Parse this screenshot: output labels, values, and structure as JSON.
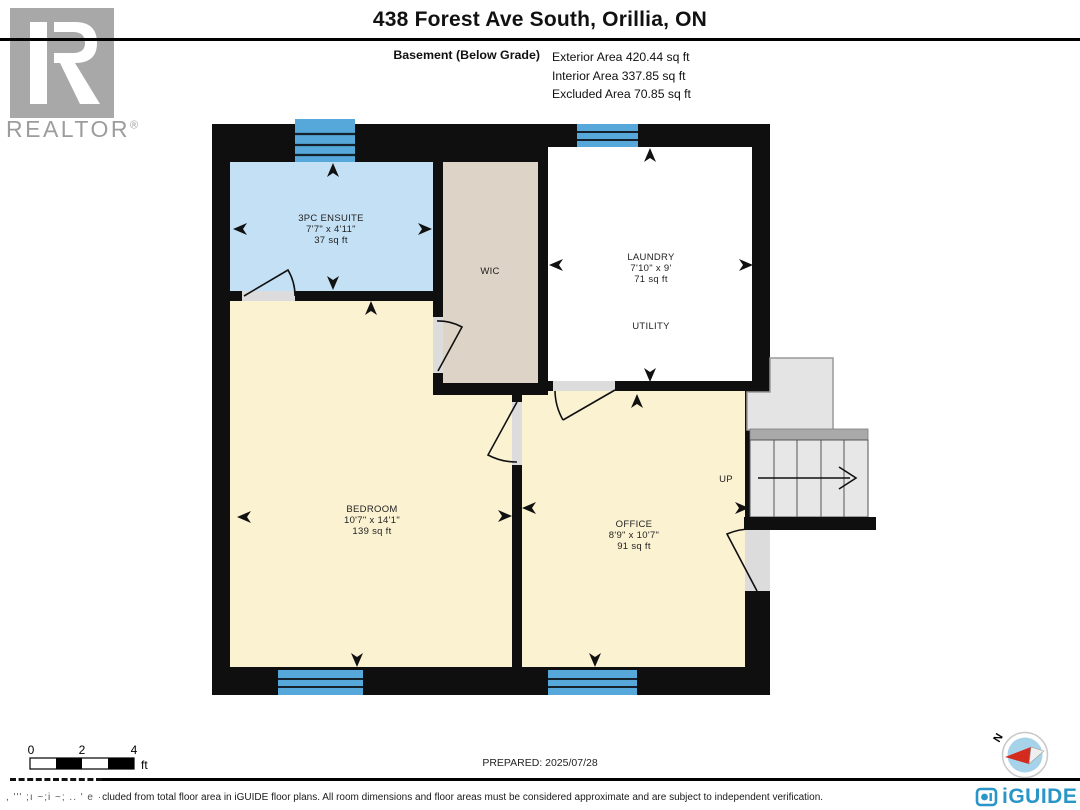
{
  "header": {
    "title": "438 Forest Ave South, Orillia, ON",
    "floor_label": "Basement (Below Grade)",
    "areas": [
      "Exterior Area 420.44 sq ft",
      "Interior Area 337.85 sq ft",
      "Excluded Area 70.85 sq ft"
    ]
  },
  "realtor_logo": {
    "label": "REALTOR",
    "reg": "®"
  },
  "rooms": [
    {
      "name": "3PC ENSUITE",
      "dims": "7'7\" x 4'11\"",
      "area": "37 sq ft"
    },
    {
      "name": "WIC"
    },
    {
      "name": "LAUNDRY",
      "dims": "7'10\" x 9'",
      "area": "71 sq ft"
    },
    {
      "name": "UTILITY"
    },
    {
      "name": "BEDROOM",
      "dims": "10'7\" x 14'1\"",
      "area": "139 sq ft"
    },
    {
      "name": "OFFICE",
      "dims": "8'9\" x 10'7\"",
      "area": "91 sq ft"
    }
  ],
  "stairs": {
    "label": "UP"
  },
  "compass": {
    "north_label": "N"
  },
  "scale_bar": {
    "ticks": [
      "0",
      "2",
      "4"
    ],
    "unit": "ft"
  },
  "footer": {
    "prepared": "PREPARED: 2025/07/28",
    "disclaimer_garbled": ", ''' ;ı ~;i ~; .. ' e ·",
    "disclaimer": "cluded from total floor area in iGUIDE floor plans. All room dimensions and floor areas must be considered approximate and are subject to independent verification.",
    "brand": "iGUIDE"
  },
  "colors": {
    "wall": "#0f0f0f",
    "ensuite_fill": "#c3e0f5",
    "wic_fill": "#ddd3c6",
    "laundry_fill": "#ffffff",
    "room_fill": "#fbf2d2",
    "window_blue": "#55a8d9",
    "opening": "#dcdcdc",
    "stairs_fill": "#e7e7e7",
    "stairs_band": "#a9a9a9",
    "landing_fill": "#e4e4e4",
    "iguide_blue": "#2a96c8",
    "realtor_gray": "#a8a8a8",
    "compass_blue": "#a6d3ea",
    "needle_red": "#d42b1e"
  }
}
